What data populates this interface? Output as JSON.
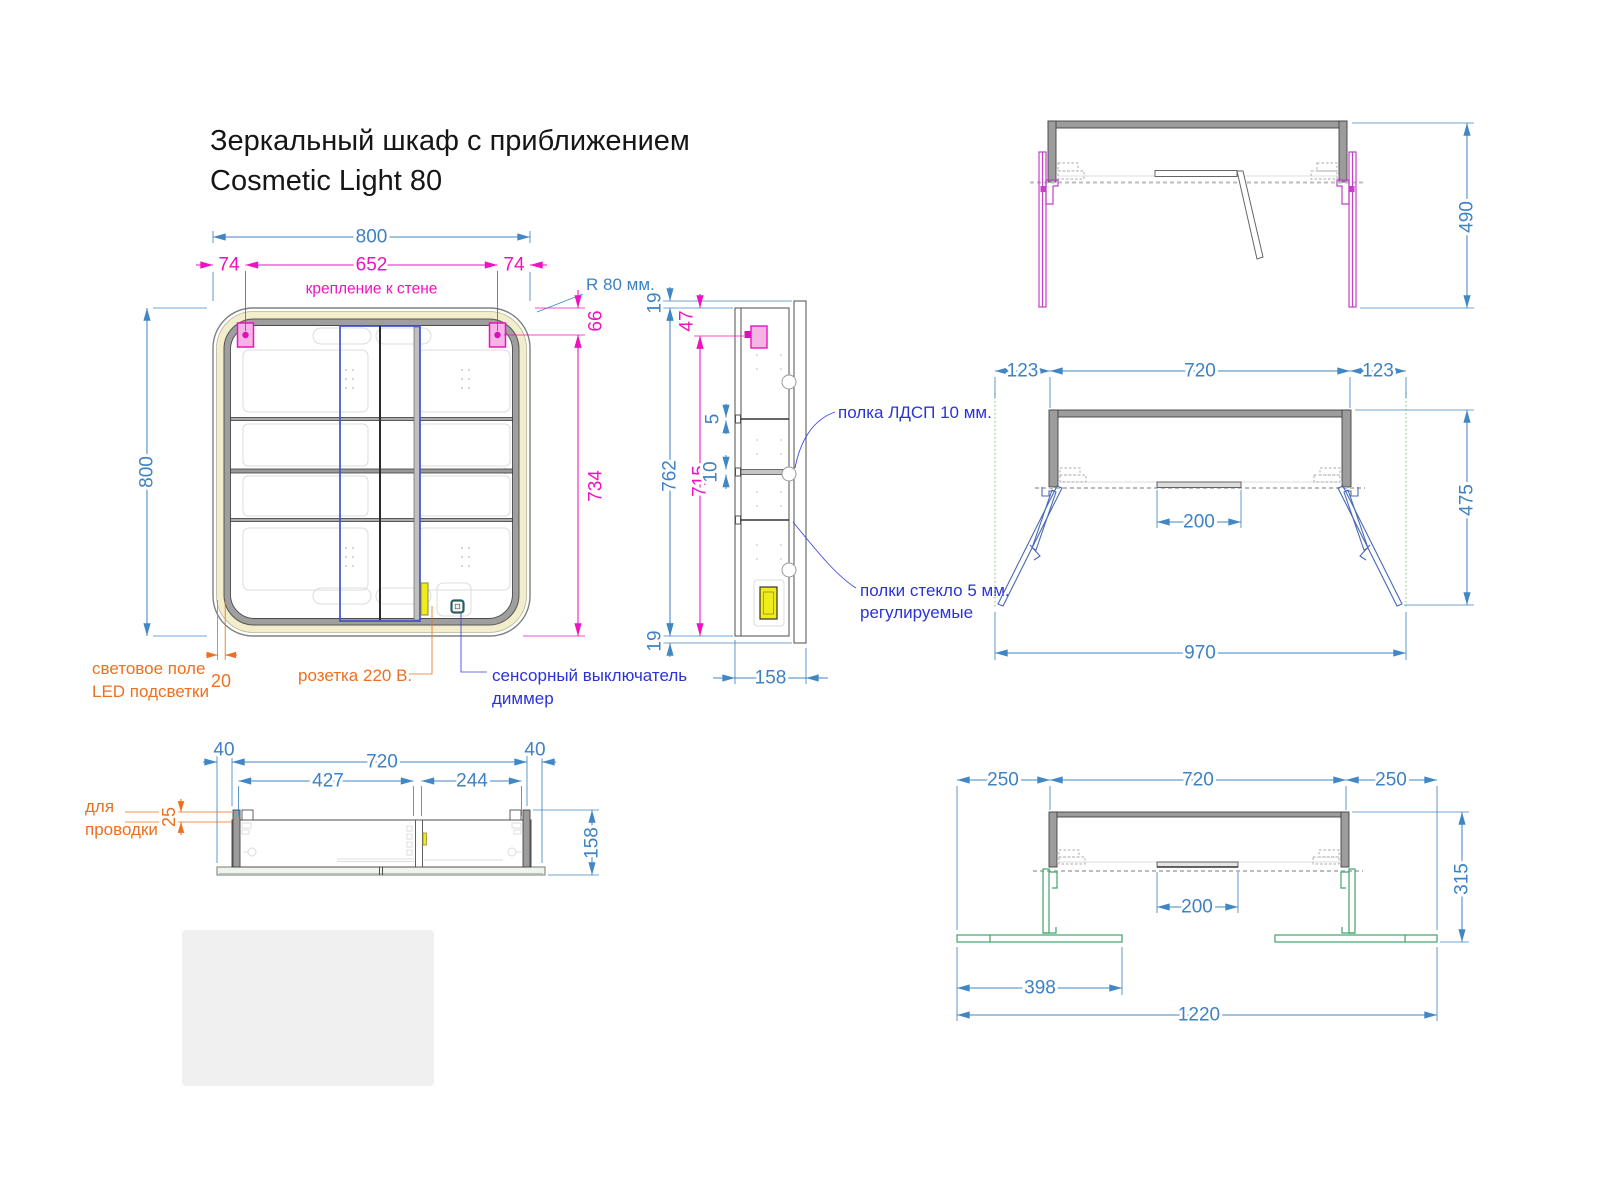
{
  "title": {
    "line1": "Зеркальный шкаф с приближением",
    "line2": "Cosmetic Light 80"
  },
  "front_view": {
    "dim_width_total": "800",
    "dim_mount_offset_left": "74",
    "dim_mount_span": "652",
    "dim_mount_offset_right": "74",
    "note_wall_mount": "крепление к стене",
    "note_corner_radius": "R 80 мм.",
    "dim_top_to_mount": "66",
    "dim_mount_to_bottom": "734",
    "dim_height_total": "800",
    "dim_led_field_width": "20",
    "label_led_line1": "световое поле",
    "label_led_line2": "LED подсветки",
    "label_socket": "розетка 220 В.",
    "label_switch_line1": "сенсорный выключатель",
    "label_switch_line2": "диммер"
  },
  "side_view": {
    "dim_back_overhang_top": "19",
    "dim_top_to_bracket": "47",
    "dim_body_height": "762",
    "dim_bracket_to_bottom": "715",
    "dim_glass_shelf_thickness": "5",
    "dim_ldsp_shelf_thickness": "10",
    "dim_back_overhang_bottom": "19",
    "dim_depth": "158",
    "label_ldsp_shelf": "полка ЛДСП 10 мм.",
    "label_glass_shelves_line1": "полки стекло 5 мм.",
    "label_glass_shelves_line2": "регулируемые"
  },
  "top_view_wall_mount": {
    "dim_depth_door_open": "490"
  },
  "top_view_doors_45": {
    "dim_side_left": "123",
    "dim_body_width": "720",
    "dim_side_right": "123",
    "dim_recess": "200",
    "dim_depth_open": "475",
    "dim_total_width": "970"
  },
  "bottom_view": {
    "dim_overhang_left": "40",
    "dim_body_width": "720",
    "dim_overhang_right": "40",
    "dim_door_left": "427",
    "dim_door_right": "244",
    "dim_wiring_gap": "25",
    "dim_depth": "158",
    "label_wiring_line1": "для",
    "label_wiring_line2": "проводки"
  },
  "top_view_doors_flat": {
    "dim_side_left": "250",
    "dim_body_width": "720",
    "dim_side_right": "250",
    "dim_recess": "200",
    "dim_depth": "315",
    "dim_door_width": "398",
    "dim_total_width": "1220"
  },
  "colors": {
    "dimension_blue": "#4187c5",
    "dimension_magenta": "#ee12c1",
    "annotation_orange": "#ed7021",
    "annotation_blue": "#2b33d8",
    "led_band_yellow": "#f2eecb",
    "bracket_pink": "#f6b3e6",
    "wall_rail_magenta": "#c23fc9",
    "door_leg_blue": "#4a69b5",
    "door_flat_green": "#3fa46a",
    "socket_yellow": "#f0ec1c",
    "frame_gray": "#9c9c9c"
  }
}
